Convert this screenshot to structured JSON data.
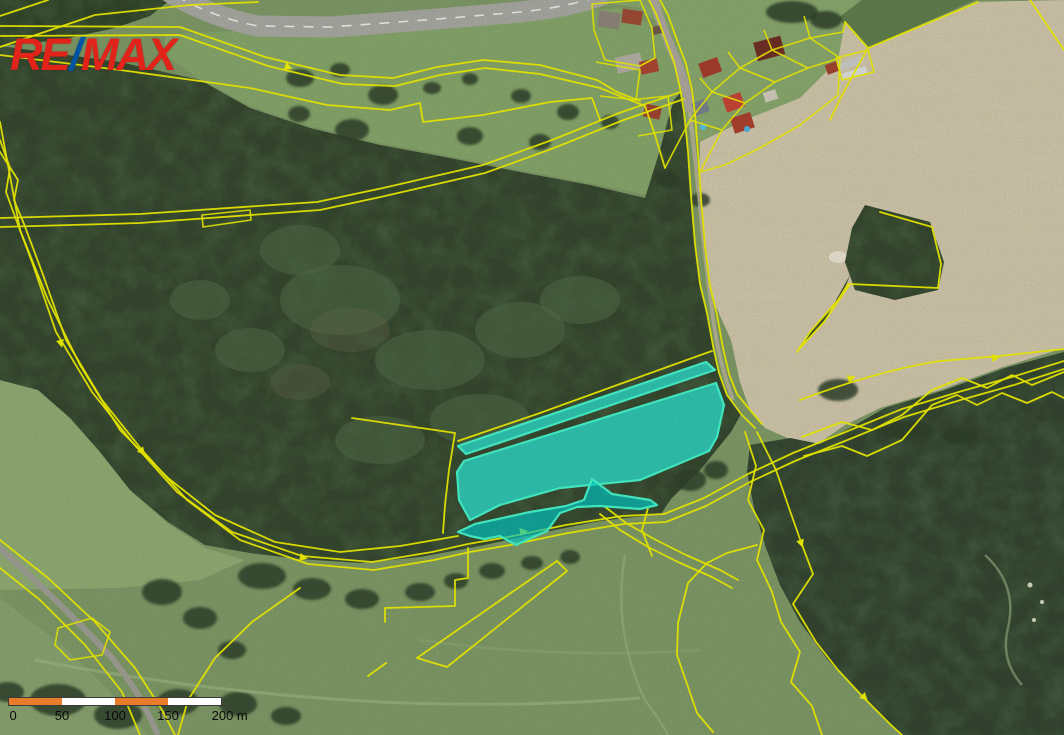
{
  "branding": {
    "re": "RE",
    "slash": "/",
    "max": "MAX"
  },
  "scale_bar": {
    "tick_labels": [
      "0",
      "50",
      "100",
      "150",
      "200 m"
    ],
    "segments": 4,
    "segment_meters": 50,
    "total_meters": 200
  },
  "map": {
    "kind": "aerial-orthophoto-with-cadastre",
    "highlighted_parcel": "cyan-highlighted land parcels (center)",
    "overlay": "yellow cadastral parcel boundaries"
  },
  "colors": {
    "remax-red": "#e2231a",
    "remax-blue": "#0054a4",
    "parcel-line": "#ecec00",
    "highlight-fill": "#00cfcf",
    "highlight-stroke": "#44efc6",
    "scale-orange": "#e87c2a",
    "scale-white": "#ffffff",
    "forest-dark": "#35462e",
    "field-beige": "#ccc3a7",
    "meadow-green": "#7d9765",
    "grass-light": "#84a369",
    "road-gray": "#a6a6a0",
    "label-black": "#0a0a0a"
  }
}
